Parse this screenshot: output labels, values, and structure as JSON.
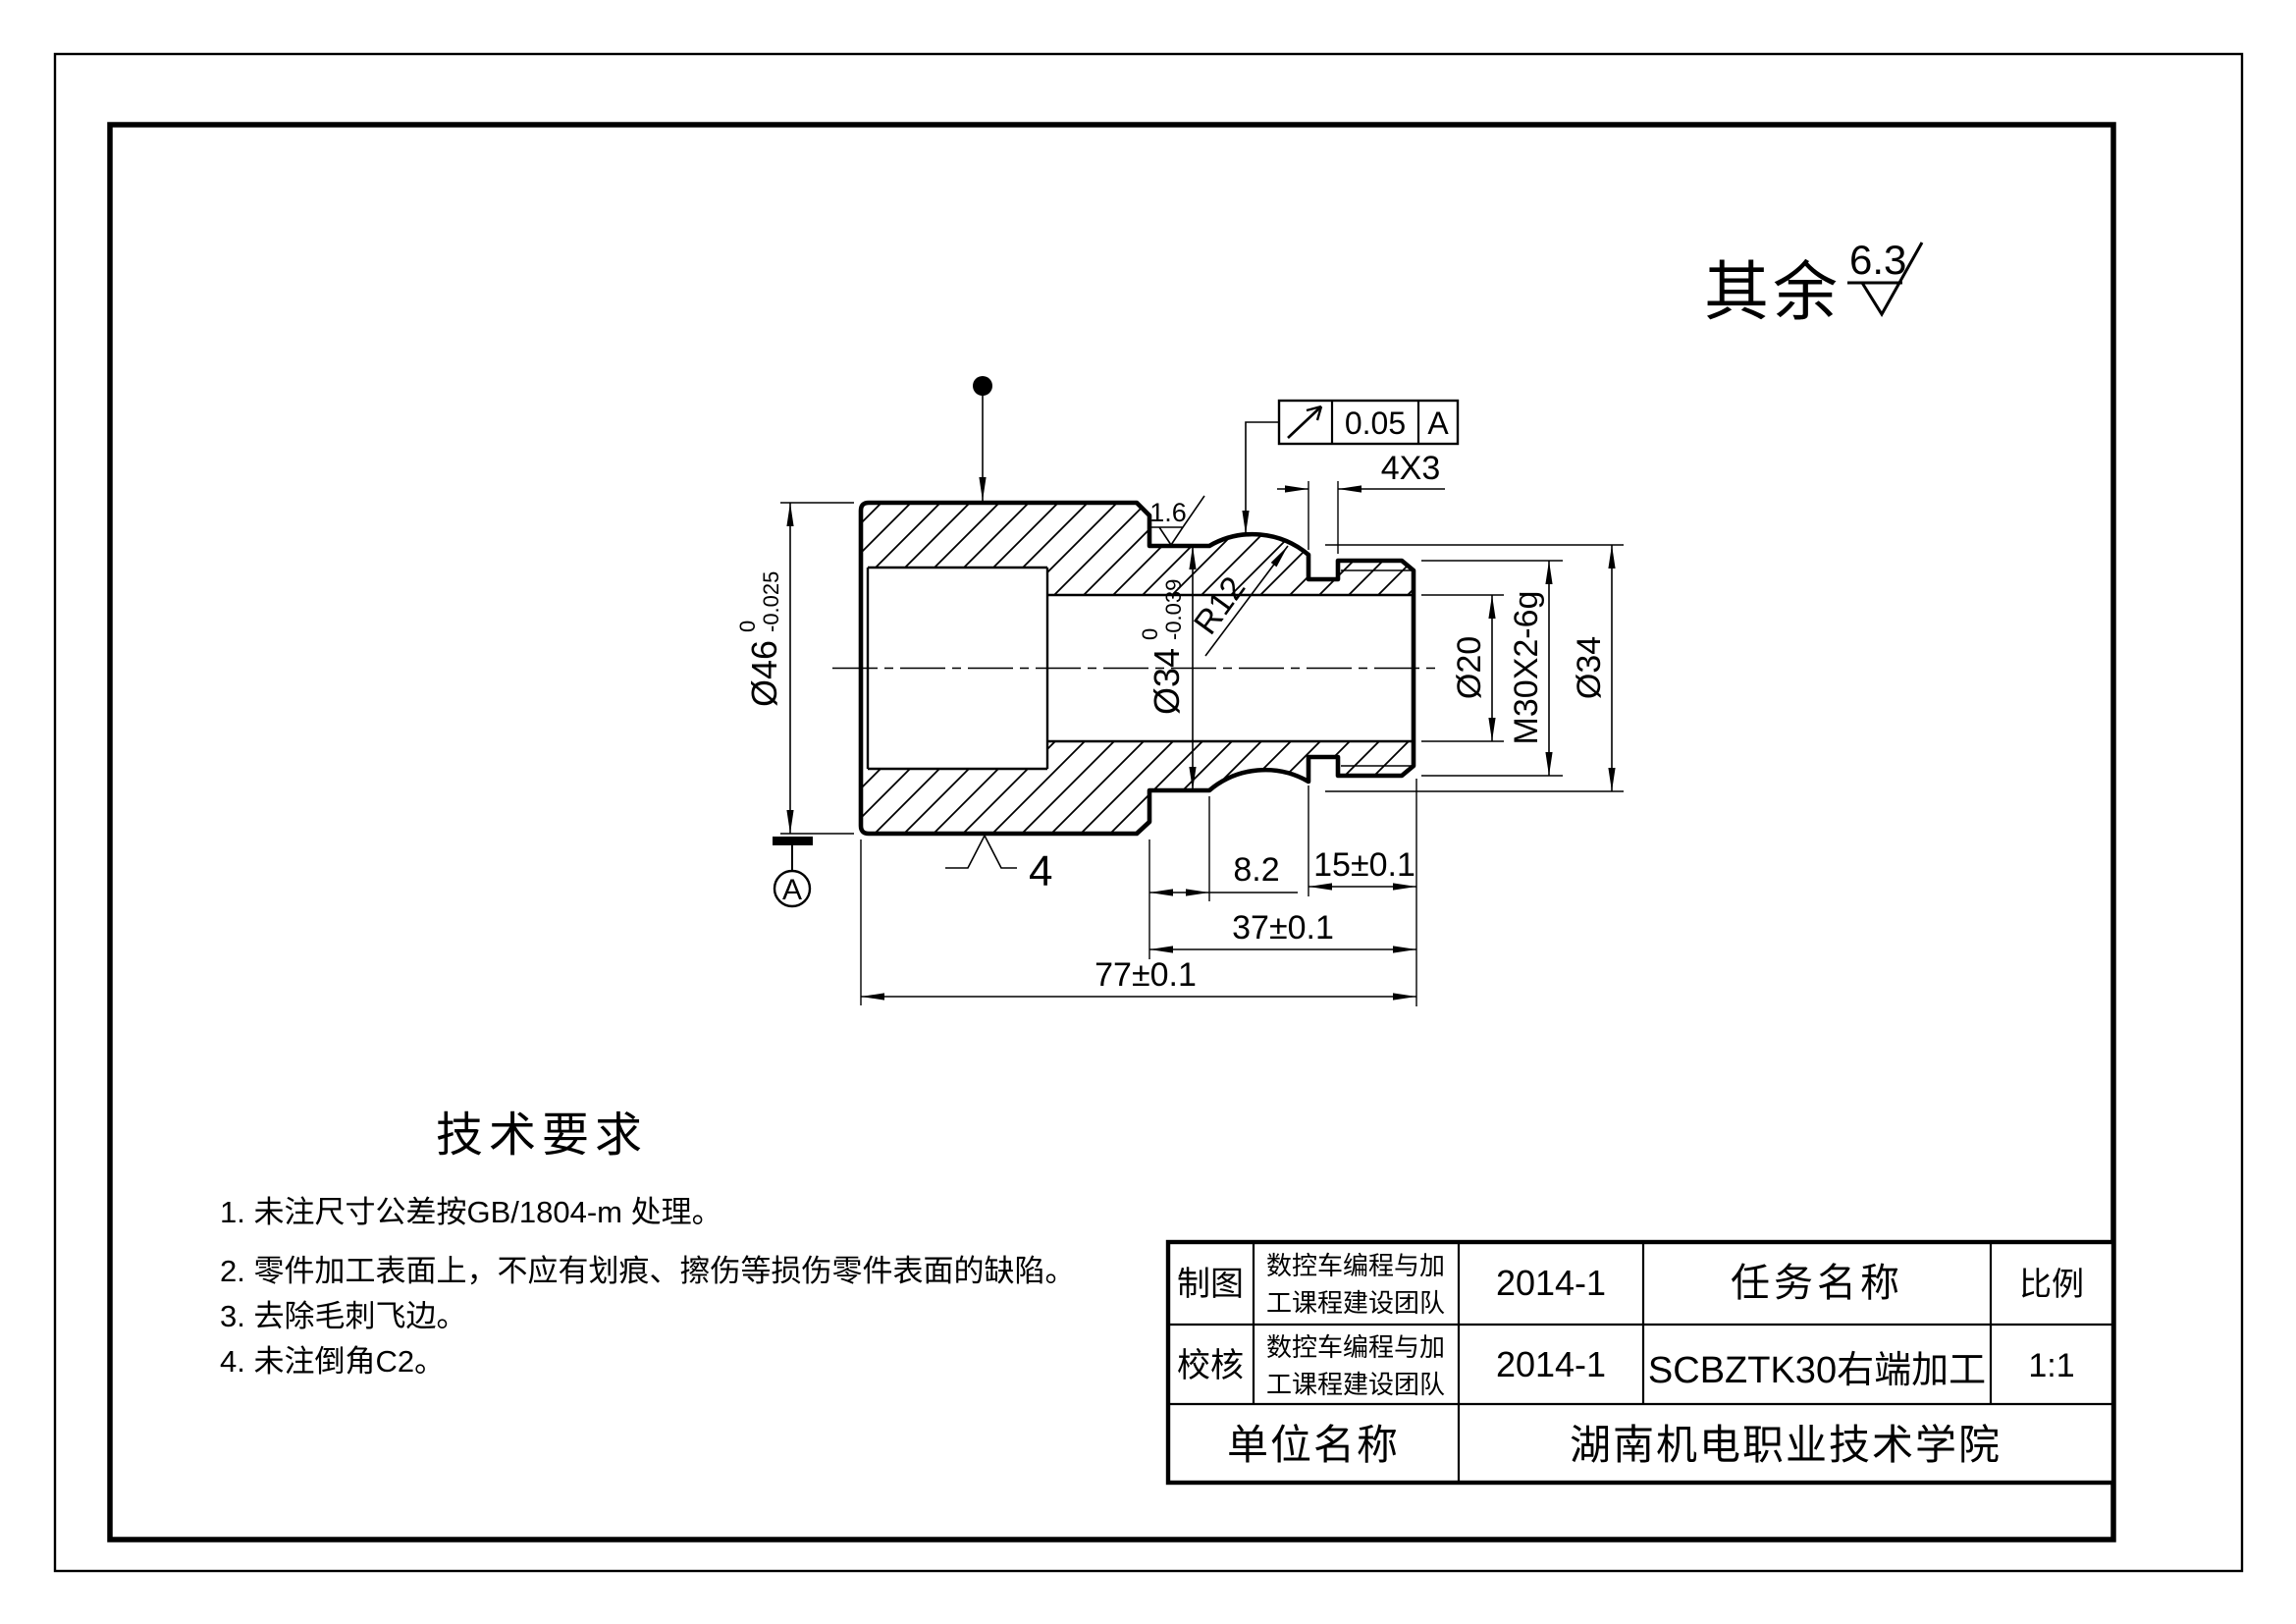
{
  "surface_note": {
    "prefix": "其余",
    "roughness": "6.3"
  },
  "feature_control_frame": {
    "symbol": "circular-runout",
    "tolerance": "0.05",
    "datum": "A"
  },
  "dims": {
    "d46_main": "Ø46",
    "d46_up": "0",
    "d46_low": "-0.025",
    "d34n_main": "Ø34",
    "d34n_up": "0",
    "d34n_low": "-0.039",
    "r12": "R12",
    "groove": "4X3",
    "d20": "Ø20",
    "thread": "M30X2-6g",
    "d34": "Ø34",
    "neck": "8.2",
    "l15": "15±0.1",
    "l37": "37±0.1",
    "l77": "77±0.1",
    "ra_neck": "1.6",
    "datum": "A",
    "surf_tag": "4"
  },
  "tech": {
    "title": "技术要求",
    "items": [
      "1. 未注尺寸公差按GB/1804-m 处理。",
      "2. 零件加工表面上，不应有划痕、擦伤等损伤零件表面的缺陷。",
      "3. 去除毛刺飞边。",
      "4. 未注倒角C2。"
    ]
  },
  "title_block": {
    "draw_role": "制图",
    "check_role": "校核",
    "team1": "数控车编程与加",
    "team2": "工课程建设团队",
    "date1": "2014-1",
    "date2": "2014-1",
    "task_header": "任务名称",
    "task_name": "SCBZTK30右端加工",
    "scale_header": "比例",
    "scale_value": "1:1",
    "org_header": "单位名称",
    "org_name": "湖南机电职业技术学院"
  }
}
